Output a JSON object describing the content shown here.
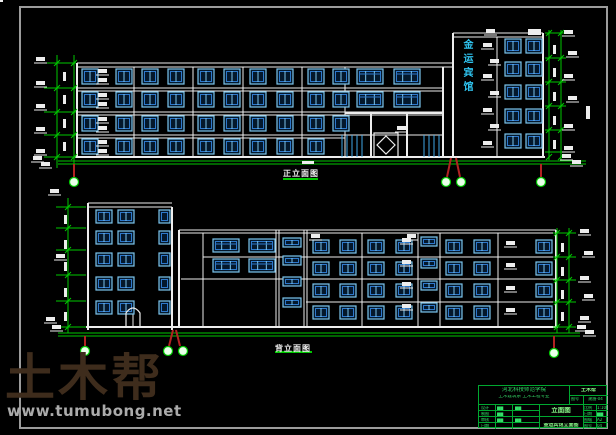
{
  "watermark": {
    "brand": "土木帮",
    "url": "www.tumubong.net",
    "brand_color": "#3E2C1C",
    "url_color": "#ABABAB"
  },
  "top_drawing": {
    "caption": "正立面图",
    "tower_sign": "金运宾馆"
  },
  "bottom_drawing": {
    "caption": "背立面图"
  },
  "title_block": {
    "school": "河北科技师范学院",
    "department": "土木建筑系 土木工程专业",
    "brand": "土木帮",
    "doc_no_label": "图号",
    "doc_no": "建施-04",
    "rows": [
      {
        "label": "设计",
        "value": "▆▆"
      },
      {
        "label": "制图",
        "value": "▆▆"
      },
      {
        "label": "审核",
        "value": "▆▆"
      },
      {
        "label": "日期",
        "value": ""
      }
    ],
    "mid": {
      "c31": "▆▆",
      "c33": "▆▆",
      "title": "立面图",
      "subtitle": "金运宾馆立面图"
    },
    "right_rows": [
      {
        "label": "比例",
        "value": "1:100"
      },
      {
        "label": "日期",
        "value": "▆▆"
      },
      {
        "label": "图幅",
        "value": "A2"
      },
      {
        "label": "图号",
        "value": "04"
      }
    ]
  },
  "colors": {
    "line_white": "#EDEDED",
    "dim_green": "#00C800",
    "axis_red": "#B22222",
    "glass_cyan": "#3FA8E8",
    "win_frame": "#7CC5EC",
    "win_inner": "#2E79CC",
    "glass_fill": "#04182C",
    "bubble_fill": "#E9FFE9",
    "frame_gray": "#9C9C9C",
    "titleblock_green": "#00A830"
  },
  "draw": {
    "lines": [
      [
        77,
        63,
        453,
        63
      ],
      [
        77,
        67,
        453,
        67
      ],
      [
        77,
        63,
        77,
        157,
        2
      ],
      [
        134,
        67,
        134,
        157
      ],
      [
        193,
        67,
        193,
        157
      ],
      [
        243,
        67,
        243,
        157
      ],
      [
        302,
        67,
        302,
        157
      ],
      [
        345,
        67,
        345,
        157
      ],
      [
        443,
        67,
        443,
        157,
        2
      ],
      [
        77,
        88,
        443,
        88
      ],
      [
        77,
        91,
        443,
        91
      ],
      [
        77,
        112,
        443,
        112
      ],
      [
        77,
        115,
        443,
        115
      ],
      [
        77,
        135,
        345,
        135
      ],
      [
        77,
        138,
        345,
        138
      ],
      [
        345,
        113,
        443,
        113,
        2
      ],
      [
        345,
        135,
        443,
        135
      ],
      [
        371,
        113,
        371,
        157,
        2
      ],
      [
        407,
        113,
        407,
        157,
        2
      ],
      [
        453,
        33,
        543,
        33
      ],
      [
        453,
        37,
        543,
        37
      ],
      [
        453,
        33,
        453,
        157,
        2
      ],
      [
        543,
        33,
        543,
        157,
        2
      ],
      [
        497,
        37,
        497,
        157
      ],
      [
        75,
        157,
        545,
        157,
        2
      ],
      [
        88,
        203,
        172,
        203
      ],
      [
        88,
        207,
        172,
        207
      ],
      [
        88,
        203,
        88,
        330,
        2
      ],
      [
        172,
        207,
        172,
        330,
        2
      ],
      [
        179,
        230,
        556,
        230
      ],
      [
        179,
        233,
        556,
        233
      ],
      [
        179,
        230,
        179,
        327,
        2
      ],
      [
        556,
        230,
        556,
        327,
        2
      ],
      [
        203,
        233,
        203,
        327
      ],
      [
        276,
        230,
        276,
        327
      ],
      [
        279,
        230,
        279,
        327
      ],
      [
        304,
        230,
        304,
        327
      ],
      [
        307,
        230,
        307,
        327
      ],
      [
        203,
        257,
        556,
        257
      ],
      [
        181,
        279,
        556,
        279
      ],
      [
        306,
        302,
        556,
        302
      ],
      [
        362,
        233,
        362,
        327
      ],
      [
        418,
        233,
        418,
        327
      ],
      [
        440,
        233,
        440,
        327
      ],
      [
        498,
        233,
        498,
        327
      ],
      [
        86,
        327,
        558,
        327,
        2
      ],
      [
        133,
        307,
        133,
        327
      ],
      [
        58,
        161,
        586,
        161,
        1,
        "g"
      ],
      [
        58,
        164,
        586,
        164,
        1,
        "g"
      ],
      [
        57,
        55,
        57,
        168,
        1,
        "g"
      ],
      [
        74,
        55,
        74,
        168,
        1,
        "g"
      ],
      [
        549,
        30,
        549,
        160,
        1,
        "g"
      ],
      [
        561,
        30,
        561,
        160,
        1,
        "g"
      ],
      [
        58,
        333,
        580,
        333,
        1,
        "g"
      ],
      [
        58,
        336,
        580,
        336,
        1,
        "g"
      ],
      [
        68,
        198,
        68,
        333,
        1,
        "g"
      ],
      [
        557,
        228,
        557,
        333,
        1,
        "g"
      ],
      [
        569,
        228,
        569,
        333,
        1,
        "g"
      ],
      [
        283,
        179,
        318,
        179,
        2,
        "g"
      ],
      [
        275,
        352,
        312,
        352,
        2,
        "g"
      ],
      [
        44,
        63,
        76,
        63,
        1,
        "g"
      ],
      [
        44,
        88,
        76,
        88,
        1,
        "g"
      ],
      [
        44,
        112,
        76,
        112,
        1,
        "g"
      ],
      [
        44,
        135,
        76,
        135,
        1,
        "g"
      ],
      [
        44,
        157,
        76,
        157,
        1,
        "g"
      ],
      [
        545,
        33,
        566,
        33,
        1,
        "g"
      ],
      [
        545,
        58,
        566,
        58,
        1,
        "g"
      ],
      [
        545,
        82,
        566,
        82,
        1,
        "g"
      ],
      [
        545,
        106,
        566,
        106,
        1,
        "g"
      ],
      [
        545,
        130,
        566,
        130,
        1,
        "g"
      ],
      [
        545,
        152,
        566,
        152,
        1,
        "g"
      ],
      [
        56,
        207,
        86,
        207,
        1,
        "g"
      ],
      [
        56,
        228,
        86,
        228,
        1,
        "g"
      ],
      [
        56,
        250,
        86,
        250,
        1,
        "g"
      ],
      [
        56,
        275,
        86,
        275,
        1,
        "g"
      ],
      [
        56,
        301,
        86,
        301,
        1,
        "g"
      ],
      [
        56,
        327,
        86,
        327,
        1,
        "g"
      ],
      [
        553,
        233,
        576,
        233,
        1,
        "g"
      ],
      [
        553,
        257,
        576,
        257,
        1,
        "g"
      ],
      [
        553,
        280,
        576,
        280,
        1,
        "g"
      ],
      [
        553,
        302,
        576,
        302,
        1,
        "g"
      ],
      [
        553,
        327,
        576,
        327,
        1,
        "g"
      ],
      [
        342,
        135,
        342,
        157,
        1,
        "c"
      ],
      [
        347,
        135,
        347,
        157,
        1,
        "c"
      ],
      [
        352,
        135,
        352,
        157,
        1,
        "c"
      ],
      [
        357,
        135,
        357,
        157,
        1,
        "c"
      ],
      [
        362,
        135,
        362,
        157,
        1,
        "c"
      ],
      [
        424,
        135,
        424,
        157,
        1,
        "c"
      ],
      [
        429,
        135,
        429,
        157,
        1,
        "c"
      ],
      [
        434,
        135,
        434,
        157,
        1,
        "c"
      ],
      [
        439,
        135,
        439,
        157,
        1,
        "c"
      ],
      [
        74,
        164,
        74,
        177,
        2,
        "r"
      ],
      [
        451,
        158,
        447,
        177,
        2,
        "r"
      ],
      [
        456,
        158,
        460,
        177,
        2,
        "r"
      ],
      [
        541,
        164,
        541,
        177,
        2,
        "r"
      ],
      [
        85,
        336,
        85,
        347,
        2,
        "r"
      ],
      [
        173,
        330,
        169,
        346,
        2,
        "r"
      ],
      [
        176,
        330,
        180,
        346,
        2,
        "r"
      ],
      [
        554,
        336,
        554,
        349,
        2,
        "r"
      ]
    ],
    "windows": [
      {
        "cols": [
          82,
          116,
          142,
          168,
          198,
          224,
          250,
          277,
          308
        ],
        "rows": [
          69,
          92,
          116,
          139
        ],
        "w": 16,
        "h": 15,
        "panes": 2
      },
      {
        "cols": [
          333
        ],
        "rows": [
          69,
          92,
          116
        ],
        "w": 16,
        "h": 15,
        "panes": 2
      },
      {
        "cols": [
          357,
          394
        ],
        "rows": [
          69,
          92
        ],
        "w": 26,
        "h": 15,
        "panes": 3
      },
      {
        "cols": [
          505,
          526
        ],
        "rows": [
          39,
          62,
          85,
          109,
          134
        ],
        "w": 16,
        "h": 14,
        "panes": 2
      },
      {
        "cols": [
          96,
          118
        ],
        "rows": [
          210,
          231,
          253,
          277,
          301
        ],
        "w": 16,
        "h": 13,
        "panes": 2
      },
      {
        "cols": [
          159
        ],
        "rows": [
          210,
          231,
          253,
          277,
          301
        ],
        "w": 11,
        "h": 13,
        "panes": 1
      },
      {
        "cols": [
          213,
          249
        ],
        "rows": [
          239,
          259
        ],
        "w": 26,
        "h": 13,
        "panes": 3
      },
      {
        "cols": [
          283
        ],
        "rows": [
          238,
          256,
          277,
          298
        ],
        "w": 18,
        "h": 9,
        "panes": 2
      },
      {
        "cols": [
          313,
          340,
          368,
          396,
          446,
          474,
          536
        ],
        "rows": [
          240,
          262,
          284,
          306
        ],
        "w": 16,
        "h": 13,
        "panes": 2
      },
      {
        "cols": [
          421
        ],
        "rows": [
          237,
          259,
          281,
          303
        ],
        "w": 16,
        "h": 9,
        "panes": 2
      }
    ],
    "ticks": [
      {
        "x": 57,
        "ys": [
          63,
          88,
          112,
          135,
          157
        ]
      },
      {
        "x": 74,
        "ys": [
          63,
          88,
          112,
          135,
          157
        ]
      },
      {
        "x": 549,
        "ys": [
          33,
          58,
          82,
          106,
          130,
          157
        ]
      },
      {
        "x": 561,
        "ys": [
          33,
          58,
          82,
          106,
          130,
          157
        ]
      },
      {
        "x": 68,
        "ys": [
          207,
          228,
          250,
          275,
          301,
          327
        ]
      },
      {
        "x": 557,
        "ys": [
          233,
          257,
          280,
          302,
          327
        ]
      },
      {
        "x": 569,
        "ys": [
          233,
          257,
          280,
          302,
          327
        ]
      }
    ],
    "flags": [
      [
        36,
        57
      ],
      [
        36,
        81
      ],
      [
        36,
        104
      ],
      [
        36,
        127
      ],
      [
        36,
        149
      ],
      [
        33,
        156
      ],
      [
        41,
        162
      ],
      [
        483,
        43
      ],
      [
        490,
        59
      ],
      [
        483,
        74
      ],
      [
        490,
        91
      ],
      [
        483,
        108
      ],
      [
        490,
        124
      ],
      [
        483,
        141
      ],
      [
        486,
        29
      ],
      [
        564,
        30
      ],
      [
        568,
        51
      ],
      [
        564,
        74
      ],
      [
        568,
        96
      ],
      [
        564,
        124
      ],
      [
        564,
        146
      ],
      [
        562,
        154
      ],
      [
        572,
        160
      ],
      [
        98,
        69
      ],
      [
        98,
        78
      ],
      [
        98,
        93
      ],
      [
        98,
        102
      ],
      [
        98,
        117
      ],
      [
        98,
        126
      ],
      [
        98,
        140
      ],
      [
        98,
        149
      ],
      [
        397,
        126
      ],
      [
        311,
        234
      ],
      [
        407,
        234
      ],
      [
        402,
        238
      ],
      [
        402,
        260
      ],
      [
        402,
        282
      ],
      [
        402,
        304
      ],
      [
        506,
        241
      ],
      [
        506,
        263
      ],
      [
        506,
        286
      ],
      [
        506,
        308
      ],
      [
        50,
        189
      ],
      [
        56,
        254
      ],
      [
        46,
        317
      ],
      [
        52,
        325
      ],
      [
        580,
        229
      ],
      [
        584,
        251
      ],
      [
        580,
        276
      ],
      [
        584,
        294
      ],
      [
        580,
        316
      ],
      [
        577,
        325
      ],
      [
        585,
        330
      ]
    ],
    "blobs": [
      [
        63,
        72,
        3,
        9
      ],
      [
        63,
        95,
        3,
        9
      ],
      [
        63,
        119,
        3,
        9
      ],
      [
        63,
        142,
        3,
        9
      ],
      [
        553,
        45,
        3,
        9
      ],
      [
        553,
        68,
        3,
        9
      ],
      [
        553,
        92,
        3,
        9
      ],
      [
        553,
        116,
        3,
        9
      ],
      [
        553,
        140,
        3,
        9
      ],
      [
        586,
        106,
        4,
        13
      ],
      [
        64,
        215,
        3,
        9
      ],
      [
        64,
        240,
        3,
        9
      ],
      [
        64,
        262,
        3,
        9
      ],
      [
        64,
        288,
        3,
        9
      ],
      [
        64,
        312,
        3,
        9
      ],
      [
        561,
        243,
        3,
        9
      ],
      [
        561,
        267,
        3,
        9
      ],
      [
        561,
        290,
        3,
        9
      ],
      [
        561,
        312,
        3,
        9
      ],
      [
        302,
        161,
        12,
        3
      ],
      [
        528,
        29,
        13,
        6
      ]
    ],
    "circles": [
      [
        74,
        182
      ],
      [
        446,
        182
      ],
      [
        461,
        182
      ],
      [
        541,
        182
      ],
      [
        85,
        351
      ],
      [
        168,
        351
      ],
      [
        183,
        351
      ],
      [
        554,
        353
      ]
    ],
    "door_rects": [
      [
        374,
        133,
        24,
        24
      ]
    ],
    "paths": [
      "M386 136 L395 145 L386 154 L377 145 Z",
      "M126 327 L126 313 Q133 303 140 313 L140 327"
    ]
  }
}
